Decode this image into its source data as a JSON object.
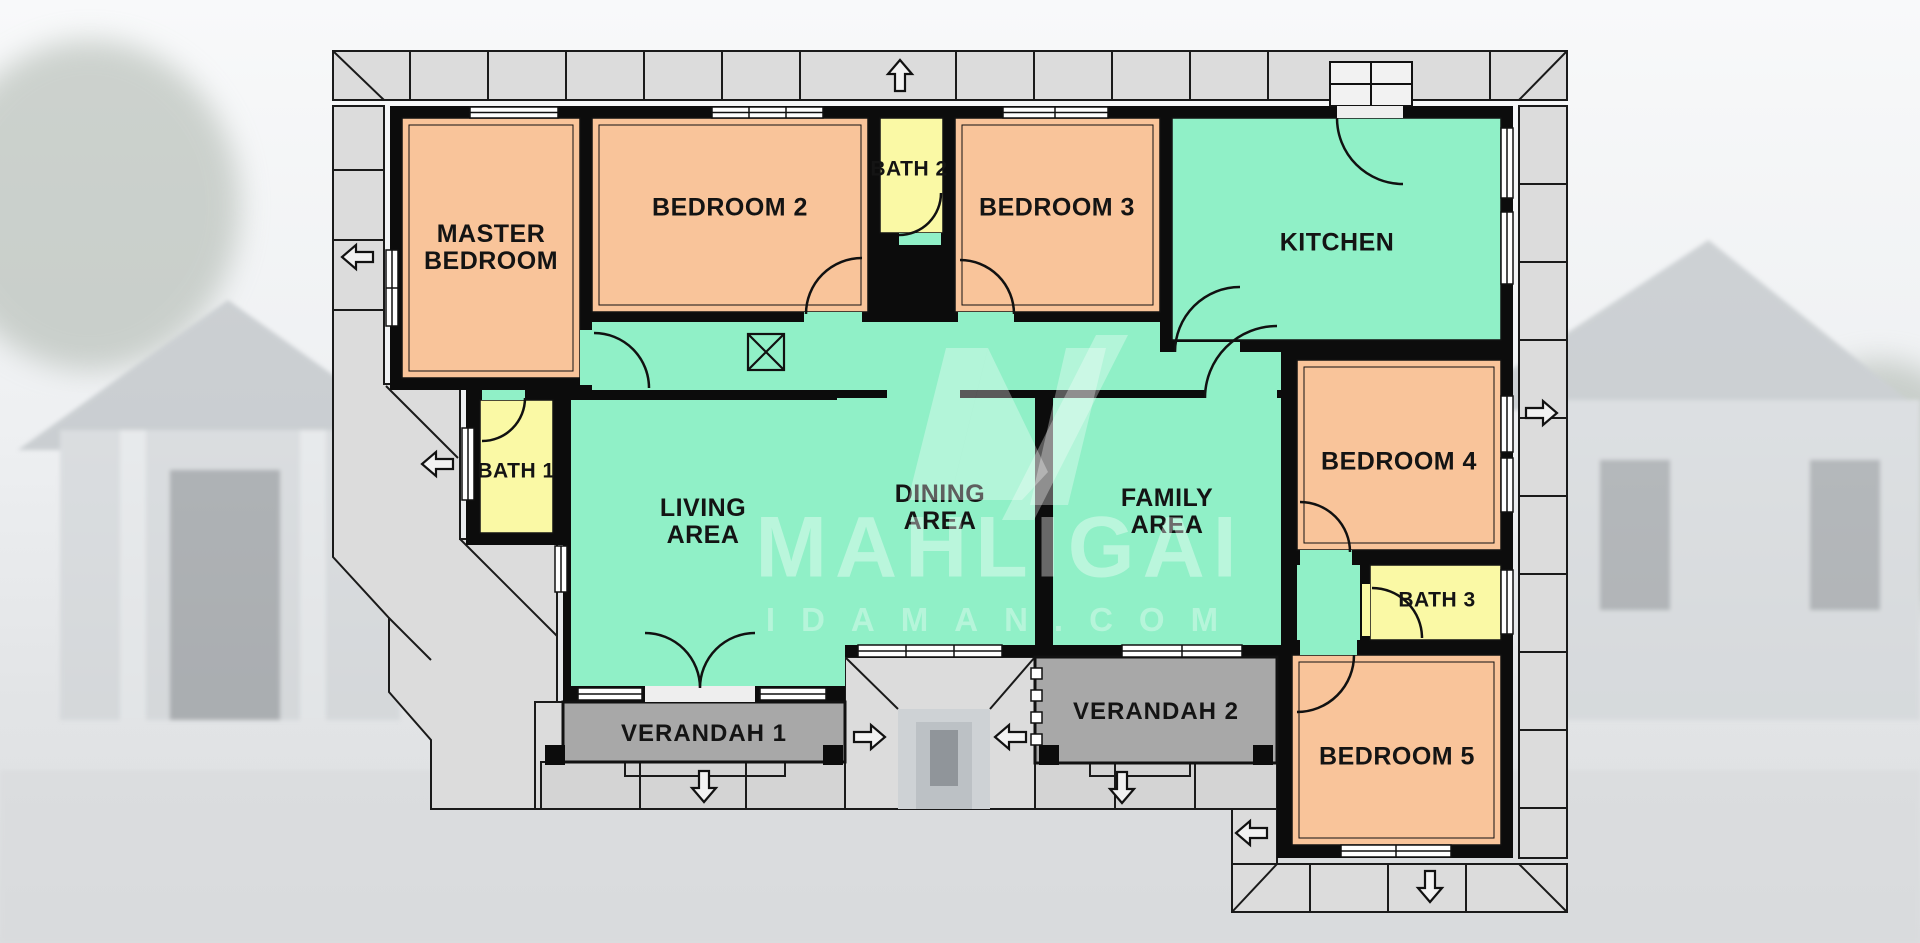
{
  "watermark": {
    "brand": "MAHLIGAI",
    "domain": "IDAMAN.COM",
    "logo": "mahligai-m-logo"
  },
  "rooms": [
    {
      "id": "master-bedroom",
      "label": "MASTER\nBEDROOM",
      "type": "bedroom"
    },
    {
      "id": "bedroom-2",
      "label": "BEDROOM 2",
      "type": "bedroom"
    },
    {
      "id": "bath-2",
      "label": "BATH 2",
      "type": "bath"
    },
    {
      "id": "bedroom-3",
      "label": "BEDROOM 3",
      "type": "bedroom"
    },
    {
      "id": "kitchen",
      "label": "KITCHEN",
      "type": "common"
    },
    {
      "id": "bath-1",
      "label": "BATH 1",
      "type": "bath"
    },
    {
      "id": "living-area",
      "label": "LIVING\nAREA",
      "type": "common"
    },
    {
      "id": "dining-area",
      "label": "DINING\nAREA",
      "type": "common"
    },
    {
      "id": "family-area",
      "label": "FAMILY\nAREA",
      "type": "common"
    },
    {
      "id": "bedroom-4",
      "label": "BEDROOM 4",
      "type": "bedroom"
    },
    {
      "id": "bath-3",
      "label": "BATH 3",
      "type": "bath"
    },
    {
      "id": "bedroom-5",
      "label": "BEDROOM 5",
      "type": "bedroom"
    },
    {
      "id": "verandah-1",
      "label": "VERANDAH 1",
      "type": "verandah"
    },
    {
      "id": "verandah-2",
      "label": "VERANDAH 2",
      "type": "verandah"
    }
  ],
  "colors": {
    "bedroom": "#F9C49A",
    "common_area": "#90F0C7",
    "bath": "#FAF9A5",
    "verandah": "#A8A8A8",
    "apron_walkway": "#DCDCDC",
    "steps": "#D4D4D4",
    "wall": "#0C0C0C",
    "watermark": "#FFFFFF"
  },
  "symbols": {
    "entry_arrows": [
      "up",
      "left",
      "left",
      "right",
      "down",
      "right",
      "left",
      "down",
      "left",
      "down"
    ],
    "x_box": "ceiling-access-symbol",
    "doors": "quarter-circle swing arcs",
    "windows": "double-line wall symbols"
  }
}
